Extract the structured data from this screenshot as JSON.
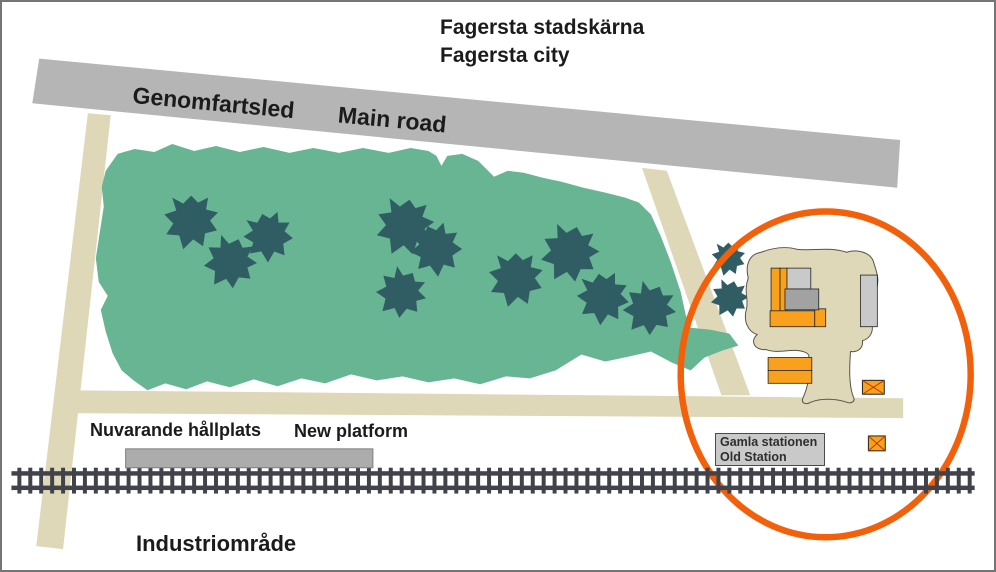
{
  "title": {
    "line1": "Fagersta stadskärna",
    "line2": "Fagersta city"
  },
  "labels": {
    "road_sv": "Genomfartsled",
    "road_en": "Main road",
    "platform_sv": "Nuvarande hållplats",
    "platform_en": "New platform",
    "station_sv": "Gamla stationen",
    "station_en": "Old Station",
    "industrial_sv": "Industriområde"
  },
  "colors": {
    "road": "#b5b5b5",
    "path": "#ded7b8",
    "forest": "#68b594",
    "forest_mottle": "#3c8a6d",
    "tree": "#2f5d63",
    "building_orange": "#f9a11c",
    "building_gray_light": "#c9c9c9",
    "building_gray": "#a2a2a2",
    "highlight_circle": "#f2600b",
    "railway": "#41424a",
    "platform_fill": "#acacac",
    "label_box_fill": "#c9c9c9",
    "text": "#1b1b1b"
  }
}
